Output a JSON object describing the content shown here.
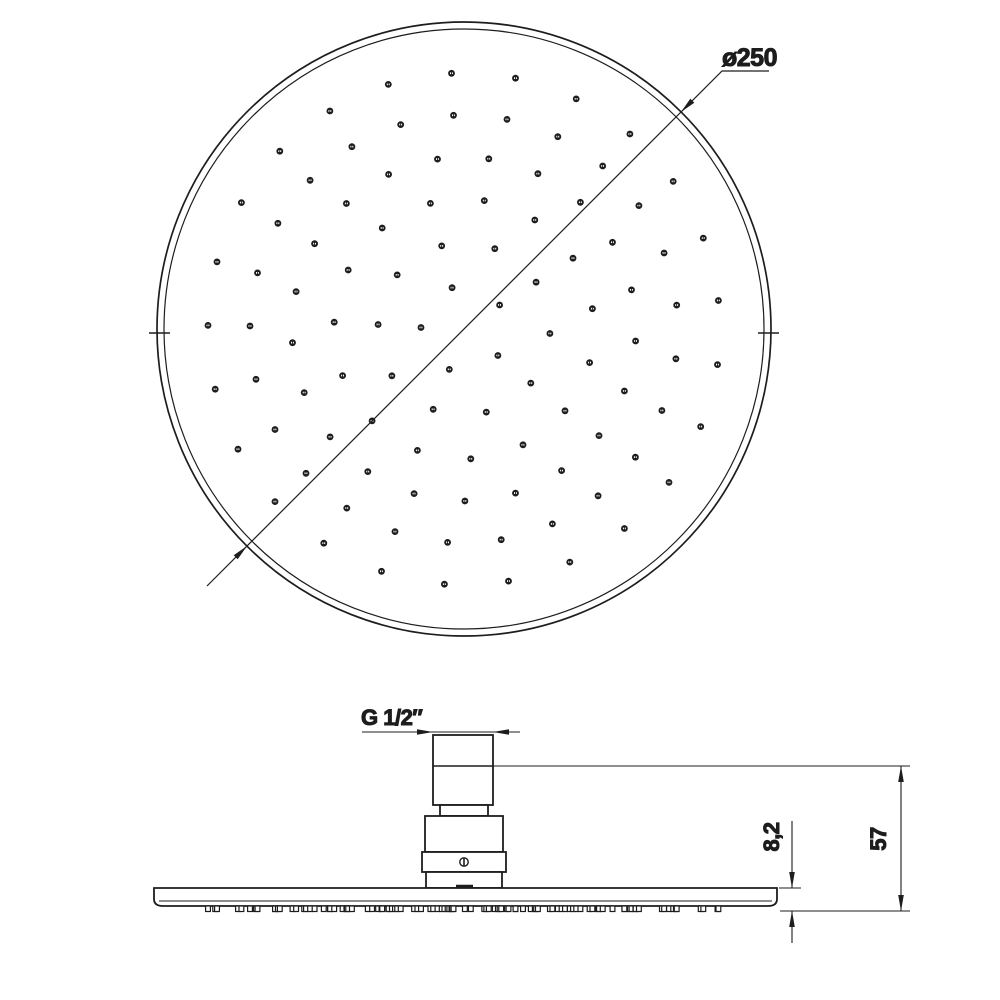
{
  "page": {
    "background": "#ffffff"
  },
  "drawing": {
    "line_color": "#1d1d1d",
    "top_view": {
      "diameter_label": "ø250",
      "rim": {
        "cx": 464,
        "cy": 329,
        "outer_r": 307,
        "inner_r": 300
      },
      "nozzle_pattern": {
        "dot_radius": 3.4,
        "rings": [
          {
            "radius": 43,
            "count": 5,
            "offset_deg": 38
          },
          {
            "radius": 86,
            "count": 10,
            "offset_deg": 3
          },
          {
            "radius": 130,
            "count": 15,
            "offset_deg": 15
          },
          {
            "radius": 172,
            "count": 21,
            "offset_deg": 4
          },
          {
            "radius": 214,
            "count": 25,
            "offset_deg": 8
          },
          {
            "radius": 256,
            "count": 25,
            "offset_deg": 8
          }
        ]
      }
    },
    "side_view": {
      "thread_label": "G 1/2″",
      "plate_thickness_label": "8,2",
      "overall_height_label": "57"
    }
  }
}
